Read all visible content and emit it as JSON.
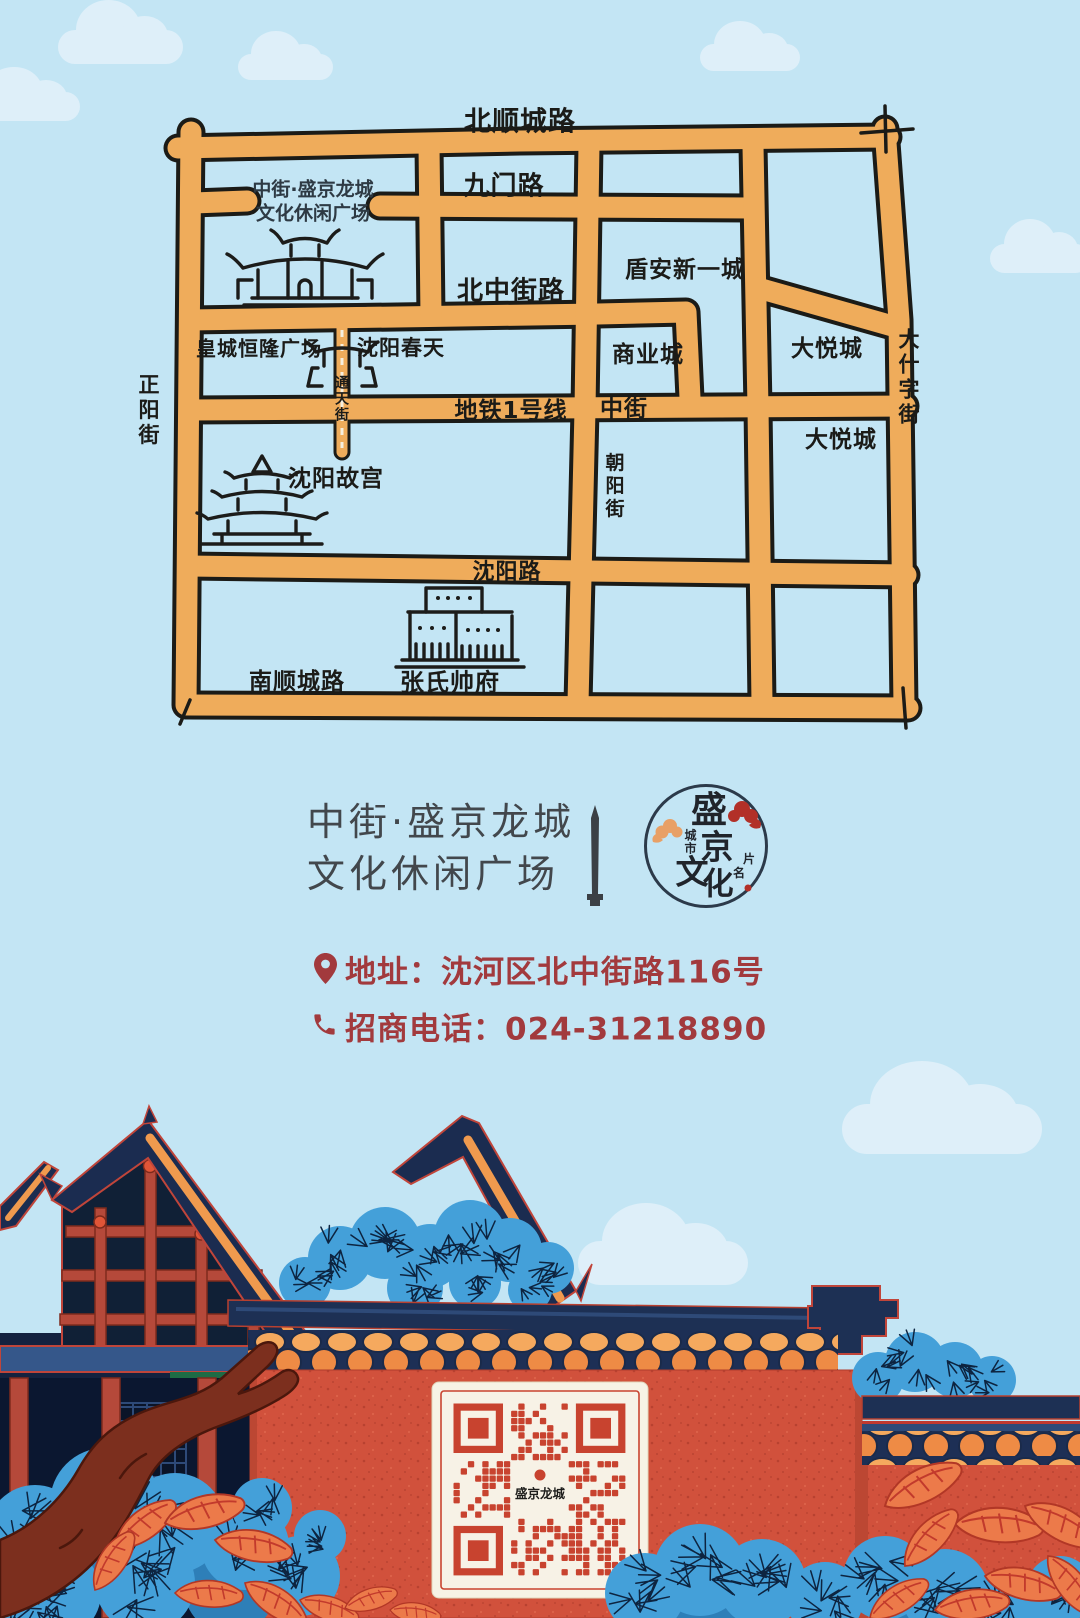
{
  "poster": {
    "title_line1": "中街·盛京龙城",
    "title_line2": "文化休闲广场",
    "address": "地址：沈河区北中街路116号",
    "phone": "招商电话：024-31218890"
  },
  "logo": {
    "char1": "盛",
    "char2": "京",
    "char3": "文",
    "char4": "化",
    "small_left": "城市",
    "small_right1": "名",
    "small_right2": "片"
  },
  "qr": {
    "center_text": "盛京龙城"
  },
  "map": {
    "labels": [
      {
        "name": "bei-shun-cheng-lu",
        "text": "北顺城路"
      },
      {
        "name": "jiu-men-lu",
        "text": "九门路"
      },
      {
        "name": "bei-zhong-jie-lu",
        "text": "北中街路"
      },
      {
        "name": "dunan-xinyicheng",
        "text": "盾安新一城"
      },
      {
        "name": "huangcheng-henglong-plaza",
        "text": "皇城恒隆广场"
      },
      {
        "name": "shenyang-chuntian",
        "text": "沈阳春天"
      },
      {
        "name": "shangyecheng",
        "text": "商业城"
      },
      {
        "name": "dayuecheng-north",
        "text": "大悦城"
      },
      {
        "name": "dayuecheng-south",
        "text": "大悦城"
      },
      {
        "name": "da-shi-zi-jie",
        "text": "大什字街"
      },
      {
        "name": "zheng-yang-jie",
        "text": "正阳街"
      },
      {
        "name": "tong-tian-jie",
        "text": "通天街"
      },
      {
        "name": "metro-line-1",
        "text": "地铁1号线"
      },
      {
        "name": "zhong-jie",
        "text": "中街"
      },
      {
        "name": "chao-yang-jie",
        "text": "朝阳街"
      },
      {
        "name": "shenyang-gugong",
        "text": "沈阳故宫"
      },
      {
        "name": "shenyang-lu",
        "text": "沈阳路"
      },
      {
        "name": "nan-shun-cheng-lu",
        "text": "南顺城路"
      },
      {
        "name": "zhangshi-shuaifu",
        "text": "张氏帅府"
      },
      {
        "name": "plaza-line1",
        "text": "中街·盛京龙城"
      },
      {
        "name": "plaza-line2",
        "text": "文化休闲广场"
      }
    ]
  },
  "colors": {
    "sky": "#c3e5f4",
    "road": "#efac5b",
    "ink": "#1b1b18",
    "title_gray": "#42474c",
    "accent_red_text": "#a23a3d",
    "wall_red": "#d1513c",
    "roof_navy": "#1b2c50",
    "tile_orange": "#f5a95e",
    "beam_red": "#b5493a",
    "pine_blue": "#44a0d9",
    "leaf_orange": "#ec7a4a"
  }
}
